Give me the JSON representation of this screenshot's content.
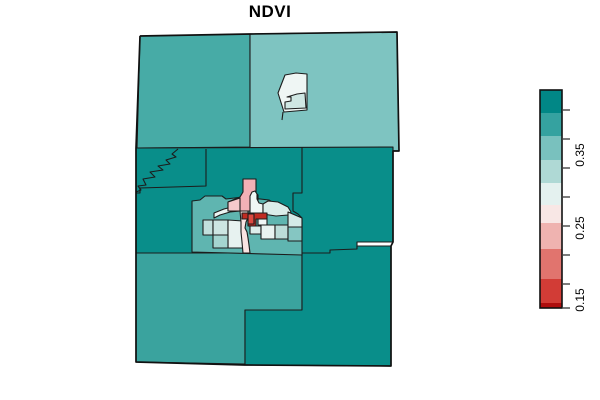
{
  "title": "NDVI",
  "legend": {
    "x": 540,
    "y": 90,
    "width": 22,
    "height": 218,
    "border_color": "#111111",
    "tick_color": "#444444",
    "bands": [
      {
        "color": "#018786",
        "h": 23
      },
      {
        "color": "#35A2A0",
        "h": 23
      },
      {
        "color": "#79C1BE",
        "h": 24
      },
      {
        "color": "#AFD9D5",
        "h": 23
      },
      {
        "color": "#E4F1EF",
        "h": 22
      },
      {
        "color": "#F8E7E5",
        "h": 18
      },
      {
        "color": "#EFB3B0",
        "h": 26
      },
      {
        "color": "#E1746E",
        "h": 30
      },
      {
        "color": "#D23C36",
        "h": 24
      },
      {
        "color": "#AE0E0E",
        "h": 5
      }
    ],
    "ticks": [
      110,
      139,
      168,
      197,
      226,
      255,
      284,
      308
    ],
    "labels": [
      {
        "text": "0.35",
        "y": 155
      },
      {
        "text": "0.25",
        "y": 228
      },
      {
        "text": "0.15",
        "y": 300
      }
    ]
  },
  "map": {
    "stroke": "#1c1c1c",
    "outer_stroke": "#111111",
    "outline": "140,36 250,34 397,32 399,151 393,151 393,242 391,246 391,366 245,365 136,362 136,253 136,148 140,36",
    "regions": [
      {
        "name": "county-top-left",
        "color": "#47ABA6",
        "points": "140,36 250,34 250,147 137,148"
      },
      {
        "name": "county-top-right",
        "color": "#7EC4C1",
        "points": "250,34 397,32 399,151 250,148"
      },
      {
        "name": "county-middle",
        "color": "#098E8A",
        "points": "136,148 393,147 393,242 357,242 357,257 302,257 302,253 136,253"
      },
      {
        "name": "county-bottom-left",
        "color": "#3AA39E",
        "points": "136,253 302,253 302,310 245,310 245,364 136,362"
      },
      {
        "name": "county-bottom-right",
        "color": "#098E8A",
        "points": "302,253 330,253 330,250 357,249 357,246 391,246 391,366 245,365 245,310 302,310"
      },
      {
        "name": "tract-island-outer",
        "color": "#EFF6F4",
        "points": "285,75 296,73 307,74 307,110 284,112 278,93"
      },
      {
        "name": "tract-island-inner",
        "color": "#CFE7E3",
        "points": "287,97 297,94 305,93 306,108 285,109 285,102 291,101 291,97"
      },
      {
        "name": "urban-area-background",
        "color": "#5FB5B0",
        "points": "192,201 200,200 205,196 222,196 226,199 243,197 269,200 278,206 285,211 295,215 302,219 302,255 192,252"
      },
      {
        "name": "tract-white-sliver",
        "color": "#ECF4F2",
        "points": "214,213 224,209 236,206 240,206 240,211 230,212 220,215 214,218"
      },
      {
        "name": "tract-pale-left",
        "color": "#C2E0DD",
        "points": "203,220 213,220 213,235 203,235"
      },
      {
        "name": "tract-square-a1",
        "color": "#CDE5E2",
        "points": "213,220 228,220 228,235 213,235"
      },
      {
        "name": "tract-square-a2",
        "color": "#E7F2F0",
        "points": "228,220 243,221 243,248 228,248"
      },
      {
        "name": "tract-square-b1",
        "color": "#A5D5D0",
        "points": "213,235 228,235 228,248 213,248"
      },
      {
        "name": "tract-pink-large",
        "color": "#F2B1B6",
        "points": "243,179 256,179 256,193 258,195 258,200 255,206 250,211 228,211 228,202 240,197 243,192"
      },
      {
        "name": "tract-pink-light",
        "color": "#F5C9CC",
        "points": "228,202 240,198 240,211 228,211"
      },
      {
        "name": "tract-white-hat",
        "color": "#F0F7F5",
        "points": "250,196 252,192 255,191 257,194 257,199 259,203 263,204 263,214 258,214 250,213 250,206"
      },
      {
        "name": "tract-pale-wide",
        "color": "#DBEDEA",
        "points": "263,204 268,201 278,202 288,207 291,212 288,215 276,216 263,214"
      },
      {
        "name": "tract-pink-strip",
        "color": "#FAE4E2",
        "points": "240,211 248,211 248,218 246,222 245,228 247,232 248,238 249,245 250,253 243,253 242,242 241,232 241,222"
      },
      {
        "name": "tract-red-bar",
        "color": "#C02B22",
        "points": "242,213 267,213 267,219 256,219 256,226 248,226 248,219 242,219"
      },
      {
        "name": "tract-red-bright",
        "color": "#DC4A41",
        "points": "248,214 254,214 254,224 248,224"
      },
      {
        "name": "tract-white-east",
        "color": "#F1F7F6",
        "points": "258,219 267,219 267,225 258,225"
      },
      {
        "name": "tract-pale-below-red",
        "color": "#DDEEEB",
        "points": "250,226 261,226 261,234 250,234"
      },
      {
        "name": "tract-white-square",
        "color": "#E9F3F1",
        "points": "261,225 275,225 275,239 261,239"
      },
      {
        "name": "tract-teal-square",
        "color": "#BCDDD9",
        "points": "275,225 288,225 288,239 275,239"
      },
      {
        "name": "tract-pale-east",
        "color": "#D5EAE7",
        "points": "288,212 302,218 302,227 288,227"
      },
      {
        "name": "tract-teal-east",
        "color": "#85C6C2",
        "points": "288,227 302,227 302,241 288,241"
      }
    ],
    "boundary_lines": [
      {
        "name": "river-squiggle-boundary",
        "points": "178,149 172,154 176,157 166,160 170,164 158,166 163,170 150,172 155,177 143,179 146,185 138,186 141,190 136,192"
      },
      {
        "name": "tract-boundary-west",
        "points": "206,149 206,186 140,188 140,193 136,193"
      },
      {
        "name": "tract-boundary-east",
        "points": "302,147 302,193 293,193 293,211 298,214 302,218"
      },
      {
        "name": "island-tail-boundary",
        "points": "283,112 282,120"
      }
    ]
  },
  "chart_data": {
    "type": "heatmap",
    "geometry": "choropleth-map",
    "title": "NDVI",
    "variable": "NDVI",
    "legend_position": "right",
    "colorbar": {
      "orientation": "vertical",
      "tick_labels": [
        "0.35",
        "0.25",
        "0.15"
      ],
      "range_approx": [
        0.11,
        0.48
      ],
      "palette": "diverging red-white-teal, 10 discrete bands top(high,teal) to bottom(low,red)"
    },
    "regions": [
      {
        "name": "county-top-left",
        "ndvi_approx": 0.4
      },
      {
        "name": "county-top-right",
        "ndvi_approx": 0.37
      },
      {
        "name": "county-middle",
        "ndvi_approx": 0.43
      },
      {
        "name": "county-bottom-left",
        "ndvi_approx": 0.4
      },
      {
        "name": "county-bottom-right",
        "ndvi_approx": 0.43
      },
      {
        "name": "tract-island-outer",
        "ndvi_approx": 0.3
      },
      {
        "name": "tract-island-inner",
        "ndvi_approx": 0.32
      },
      {
        "name": "urban-area-background",
        "ndvi_approx": 0.39
      },
      {
        "name": "tract-white-sliver",
        "ndvi_approx": 0.3
      },
      {
        "name": "tract-pale-left",
        "ndvi_approx": 0.33
      },
      {
        "name": "tract-square-a1",
        "ndvi_approx": 0.32
      },
      {
        "name": "tract-square-a2",
        "ndvi_approx": 0.31
      },
      {
        "name": "tract-square-b1",
        "ndvi_approx": 0.35
      },
      {
        "name": "tract-pink-large",
        "ndvi_approx": 0.23
      },
      {
        "name": "tract-pink-light",
        "ndvi_approx": 0.25
      },
      {
        "name": "tract-white-hat",
        "ndvi_approx": 0.3
      },
      {
        "name": "tract-pale-wide",
        "ndvi_approx": 0.32
      },
      {
        "name": "tract-pink-strip",
        "ndvi_approx": 0.27
      },
      {
        "name": "tract-red-bar",
        "ndvi_approx": 0.14
      },
      {
        "name": "tract-red-bright",
        "ndvi_approx": 0.16
      },
      {
        "name": "tract-white-east",
        "ndvi_approx": 0.3
      },
      {
        "name": "tract-pale-below-red",
        "ndvi_approx": 0.31
      },
      {
        "name": "tract-white-square",
        "ndvi_approx": 0.3
      },
      {
        "name": "tract-teal-square",
        "ndvi_approx": 0.33
      },
      {
        "name": "tract-pale-east",
        "ndvi_approx": 0.32
      },
      {
        "name": "tract-teal-east",
        "ndvi_approx": 0.36
      }
    ]
  }
}
